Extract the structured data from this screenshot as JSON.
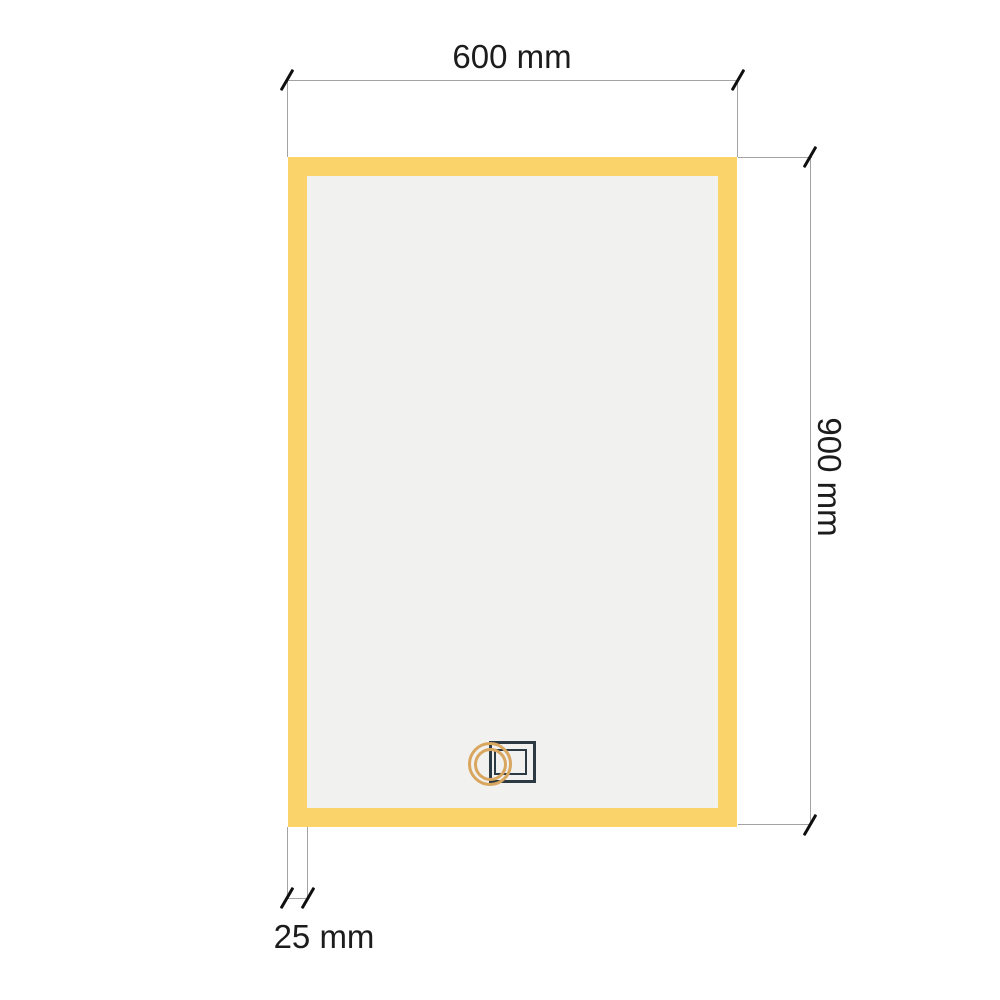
{
  "drawing": {
    "kind": "mirror-dimension-diagram",
    "dimension_labels": {
      "width": "600 mm",
      "height": "900 mm",
      "frame_thickness": "25 mm"
    },
    "icons": [
      {
        "name": "touch-sensor-icon"
      }
    ],
    "colors": {
      "background": "#FFFFFF",
      "frame_yellow": "#FAD46A",
      "mirror_surface": "#F1F1EF",
      "dimension_line": "#A3A3A3",
      "tick_mark": "#0F0F0F",
      "label_text": "#1C1C1C",
      "sensor_ring": "#D9A65F",
      "sensor_frame": "#2B3A43"
    }
  }
}
